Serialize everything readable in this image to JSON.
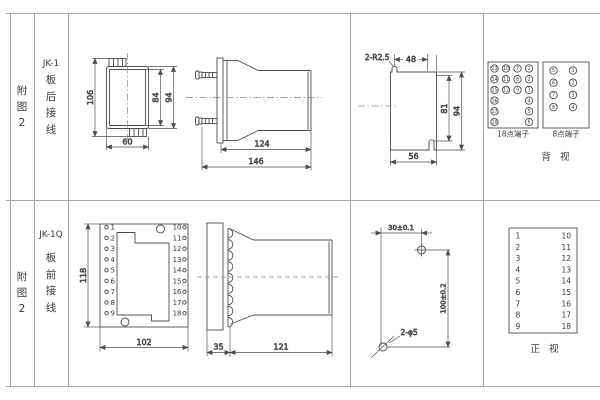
{
  "row_back": {
    "fig": [
      "附",
      "图",
      "2"
    ],
    "model_title": "JK-1",
    "model_chars": [
      "板",
      "后",
      "接",
      "线"
    ],
    "face_view": {
      "dim_total_height": "106",
      "dim_inner_height": "84",
      "dim_outer_height": "94",
      "dim_width": "60"
    },
    "side_view": {
      "dim_body": "124",
      "dim_total": "146"
    },
    "cutout": {
      "radius_label": "2-R2.5",
      "dim_top": "48",
      "dim_slot_height": "81",
      "dim_height": "94",
      "dim_width": "56"
    },
    "terminals_18": {
      "label": "18点端子",
      "cells": [
        {
          "n": "13",
          "c": 0,
          "r": 0
        },
        {
          "n": "10",
          "c": 1,
          "r": 0
        },
        {
          "n": "7",
          "c": 2,
          "r": 0
        },
        {
          "n": "1",
          "c": 3,
          "r": 0
        },
        {
          "n": "14",
          "c": 0,
          "r": 1
        },
        {
          "n": "11",
          "c": 1,
          "r": 1
        },
        {
          "n": "8",
          "c": 2,
          "r": 1
        },
        {
          "n": "2",
          "c": 3,
          "r": 1
        },
        {
          "n": "15",
          "c": 0,
          "r": 2
        },
        {
          "n": "12",
          "c": 1,
          "r": 2
        },
        {
          "n": "9",
          "c": 2,
          "r": 2
        },
        {
          "n": "3",
          "c": 3,
          "r": 2
        },
        {
          "n": "16",
          "c": 0,
          "r": 3
        },
        {
          "n": "4",
          "c": 3,
          "r": 3
        },
        {
          "n": "17",
          "c": 0,
          "r": 4
        },
        {
          "n": "5",
          "c": 3,
          "r": 4
        },
        {
          "n": "18",
          "c": 0,
          "r": 5
        },
        {
          "n": "6",
          "c": 3,
          "r": 5
        }
      ]
    },
    "terminals_8": {
      "label": "8点端子",
      "cells": [
        {
          "n": "5",
          "c": 0,
          "r": 0
        },
        {
          "n": "1",
          "c": 1,
          "r": 0
        },
        {
          "n": "6",
          "c": 0,
          "r": 1
        },
        {
          "n": "2",
          "c": 1,
          "r": 1
        },
        {
          "n": "7",
          "c": 0,
          "r": 2
        },
        {
          "n": "3",
          "c": 1,
          "r": 2
        },
        {
          "n": "8",
          "c": 0,
          "r": 3
        },
        {
          "n": "4",
          "c": 1,
          "r": 3
        }
      ]
    },
    "view_label": "背 视"
  },
  "row_front": {
    "fig": [
      "附",
      "图",
      "2"
    ],
    "model_title": "JK-1Q",
    "model_chars": [
      "板",
      "前",
      "接",
      "线"
    ],
    "front_view": {
      "dim_height": "118",
      "dim_width": "102",
      "left_terminals": [
        "1",
        "2",
        "3",
        "4",
        "5",
        "6",
        "7",
        "8",
        "9"
      ],
      "right_terminals": [
        "10",
        "11",
        "12",
        "13",
        "14",
        "15",
        "16",
        "17",
        "18"
      ]
    },
    "side_view": {
      "dim_flange": "35",
      "dim_body": "121"
    },
    "drilling": {
      "dim_horizontal": "30±0.1",
      "dim_vertical": "100±0.2",
      "holes_label": "2-φ5"
    },
    "terminal_table": {
      "left": [
        "1",
        "2",
        "3",
        "4",
        "5",
        "6",
        "7",
        "8",
        "9"
      ],
      "right": [
        "10",
        "11",
        "12",
        "13",
        "14",
        "15",
        "16",
        "17",
        "18"
      ]
    },
    "view_label": "正 视"
  }
}
